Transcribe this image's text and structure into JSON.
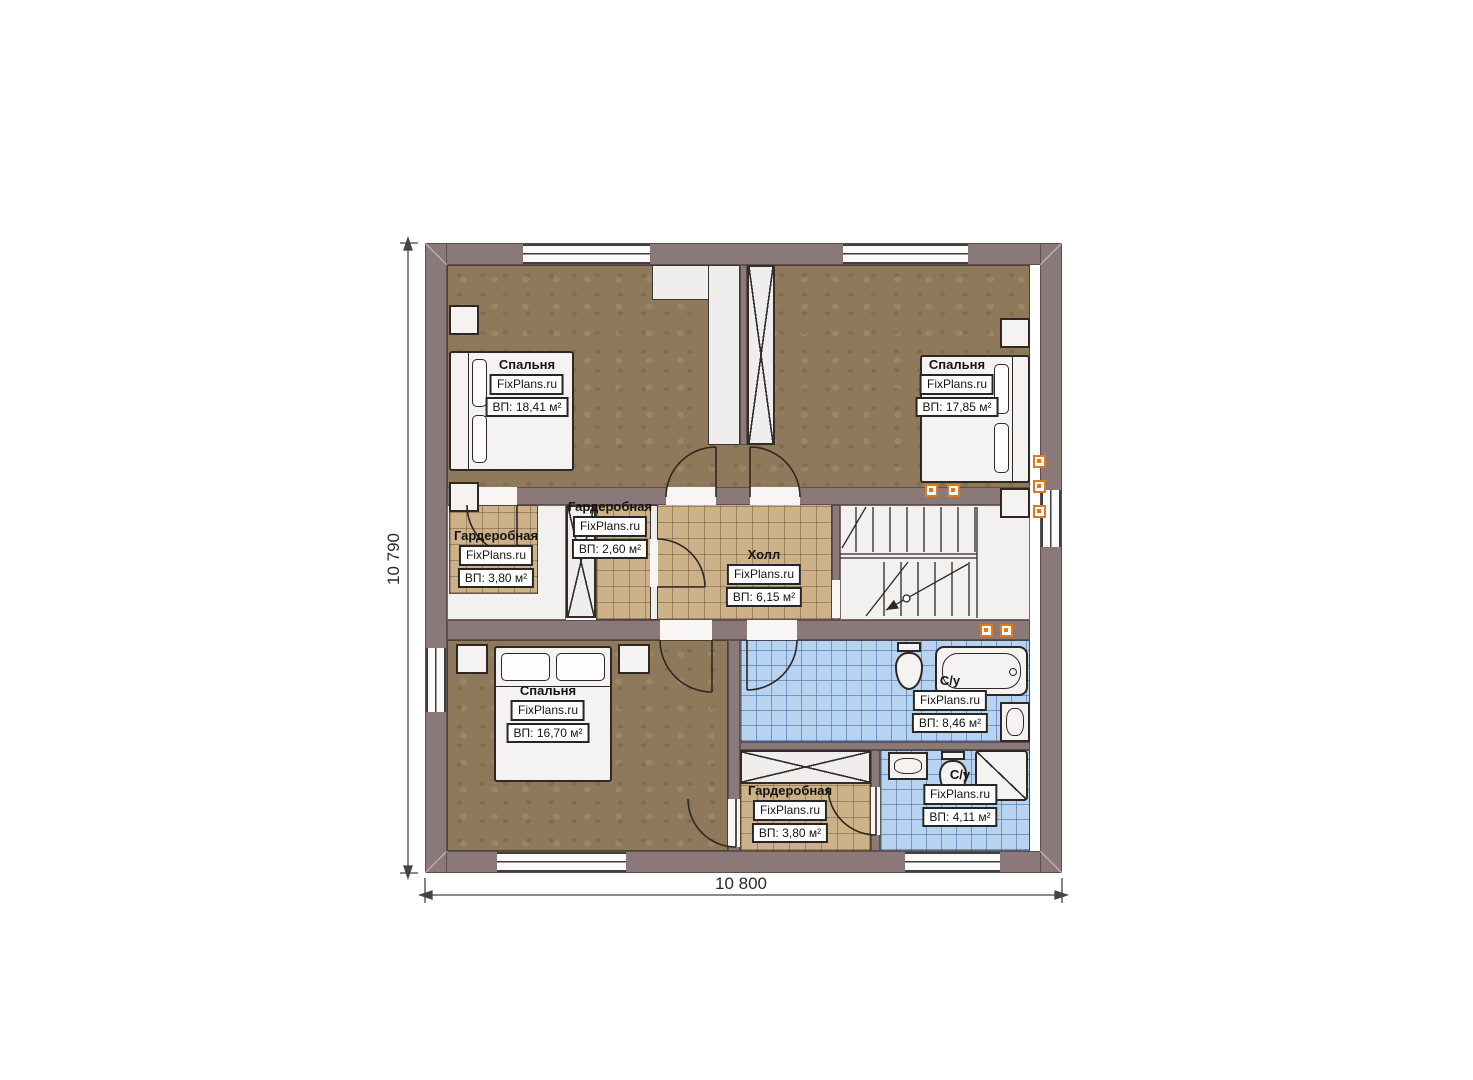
{
  "plan": {
    "brand": "FixPlans.ru",
    "dimensions": {
      "bottom": "10 800",
      "left": "10 790"
    },
    "rooms": [
      {
        "id": "bedroom-1",
        "name": "Спальня",
        "brand": "FixPlans.ru",
        "area": "ВП: 18,41 м²"
      },
      {
        "id": "bedroom-2",
        "name": "Спальня",
        "brand": "FixPlans.ru",
        "area": "ВП: 17,85 м²"
      },
      {
        "id": "wardrobe-left",
        "name": "Гардеробная",
        "brand": "FixPlans.ru",
        "area": "ВП: 3,80 м²"
      },
      {
        "id": "wardrobe-middle",
        "name": "Гардеробная",
        "brand": "FixPlans.ru",
        "area": "ВП: 2,60 м²"
      },
      {
        "id": "hall",
        "name": "Холл",
        "brand": "FixPlans.ru",
        "area": "ВП: 6,15 м²"
      },
      {
        "id": "bedroom-3",
        "name": "Спальня",
        "brand": "FixPlans.ru",
        "area": "ВП: 16,70 м²"
      },
      {
        "id": "bathroom-big",
        "name": "С/у",
        "brand": "FixPlans.ru",
        "area": "ВП: 8,46 м²"
      },
      {
        "id": "wardrobe-bottom",
        "name": "Гардеробная",
        "brand": "FixPlans.ru",
        "area": "ВП: 3,80 м²"
      },
      {
        "id": "bathroom-small",
        "name": "С/у",
        "brand": "FixPlans.ru",
        "area": "ВП: 4,11 м²"
      }
    ],
    "symbols": [
      "double-bed",
      "pillow",
      "nightstand",
      "toilet",
      "bathtub",
      "washbasin",
      "shower-cabin",
      "staircase",
      "wardrobe-cabinet",
      "vent-shaft",
      "window",
      "ceiling-light",
      "door-arc"
    ],
    "colors": {
      "wall": "#8b7979",
      "bedroom_floor": "#8e795b",
      "tile_beige": "#ccb189",
      "tile_blue": "#b7d3f0",
      "accent_orange": "#e07820"
    }
  }
}
